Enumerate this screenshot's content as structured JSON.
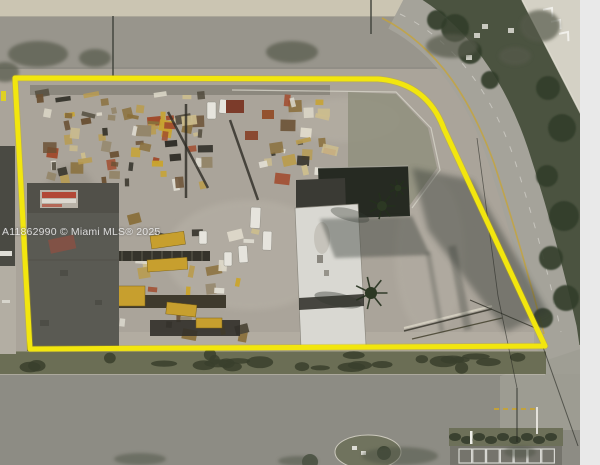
{
  "watermark": {
    "text": "A11862990 © Miami MLS® 2025"
  },
  "boundary": {
    "path": "M 15 78 L 378 79 Q 427 83 444 129 L 545 346 L 30 349 Z",
    "color": "#f2e60e",
    "underlay_color": "#c9b400",
    "stroke_width": 5
  },
  "palette": {
    "ground": "#aaa49a",
    "ground_light": "#b8b2a7",
    "sand": "#cbc5b2",
    "road_top": "#98958c",
    "road_curved": "#a5a39a",
    "road_bottom": "#8d8c84",
    "grass_dark": "#4b5340",
    "grass_medium": "#6b6e55",
    "grass_pale": "#8e8e7c",
    "roof_dark": "#5a5a53",
    "roof_white": "#d9d8d2",
    "building_dark": "#262a22",
    "shadow": "#333830",
    "line_yellow": "#c8a433",
    "white": "#f2f1ec",
    "margin_strip": "#e9e9e9"
  }
}
